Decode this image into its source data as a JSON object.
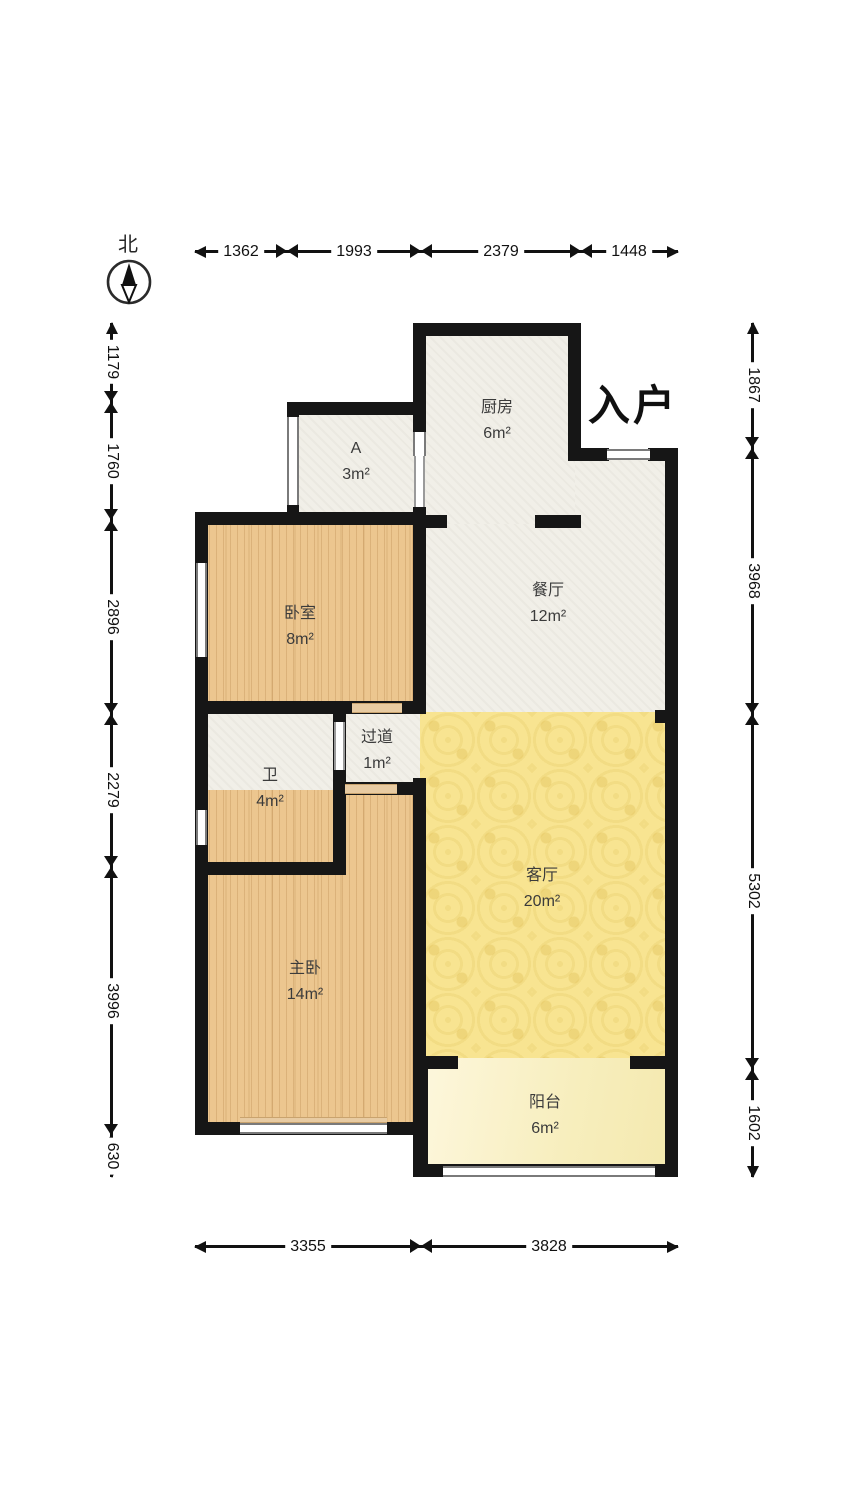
{
  "compass": {
    "north_label": "北"
  },
  "entrance_label": "入户",
  "rooms": {
    "kitchen": {
      "name": "厨房",
      "area": "6m²"
    },
    "storage_a": {
      "name": "A",
      "area": "3m²"
    },
    "bedroom": {
      "name": "卧室",
      "area": "8m²"
    },
    "dining": {
      "name": "餐厅",
      "area": "12m²"
    },
    "hallway": {
      "name": "过道",
      "area": "1m²"
    },
    "bathroom": {
      "name": "卫",
      "area": "4m²"
    },
    "living": {
      "name": "客厅",
      "area": "20m²"
    },
    "master_bedroom": {
      "name": "主卧",
      "area": "14m²"
    },
    "balcony": {
      "name": "阳台",
      "area": "6m²"
    }
  },
  "dimensions": {
    "top": [
      "1362",
      "1993",
      "2379",
      "1448"
    ],
    "bottom": [
      "3355",
      "3828"
    ],
    "left": [
      "1179",
      "1760",
      "2896",
      "2279",
      "3996",
      "630"
    ],
    "right": [
      "1867",
      "3968",
      "5302",
      "1602"
    ]
  },
  "colors": {
    "wall": "#161616",
    "wood_floor": "#ecc68f",
    "living_floor": "#f8e491",
    "balcony_floor": "#f8f0c8",
    "neutral_floor": "#f1efe8"
  }
}
